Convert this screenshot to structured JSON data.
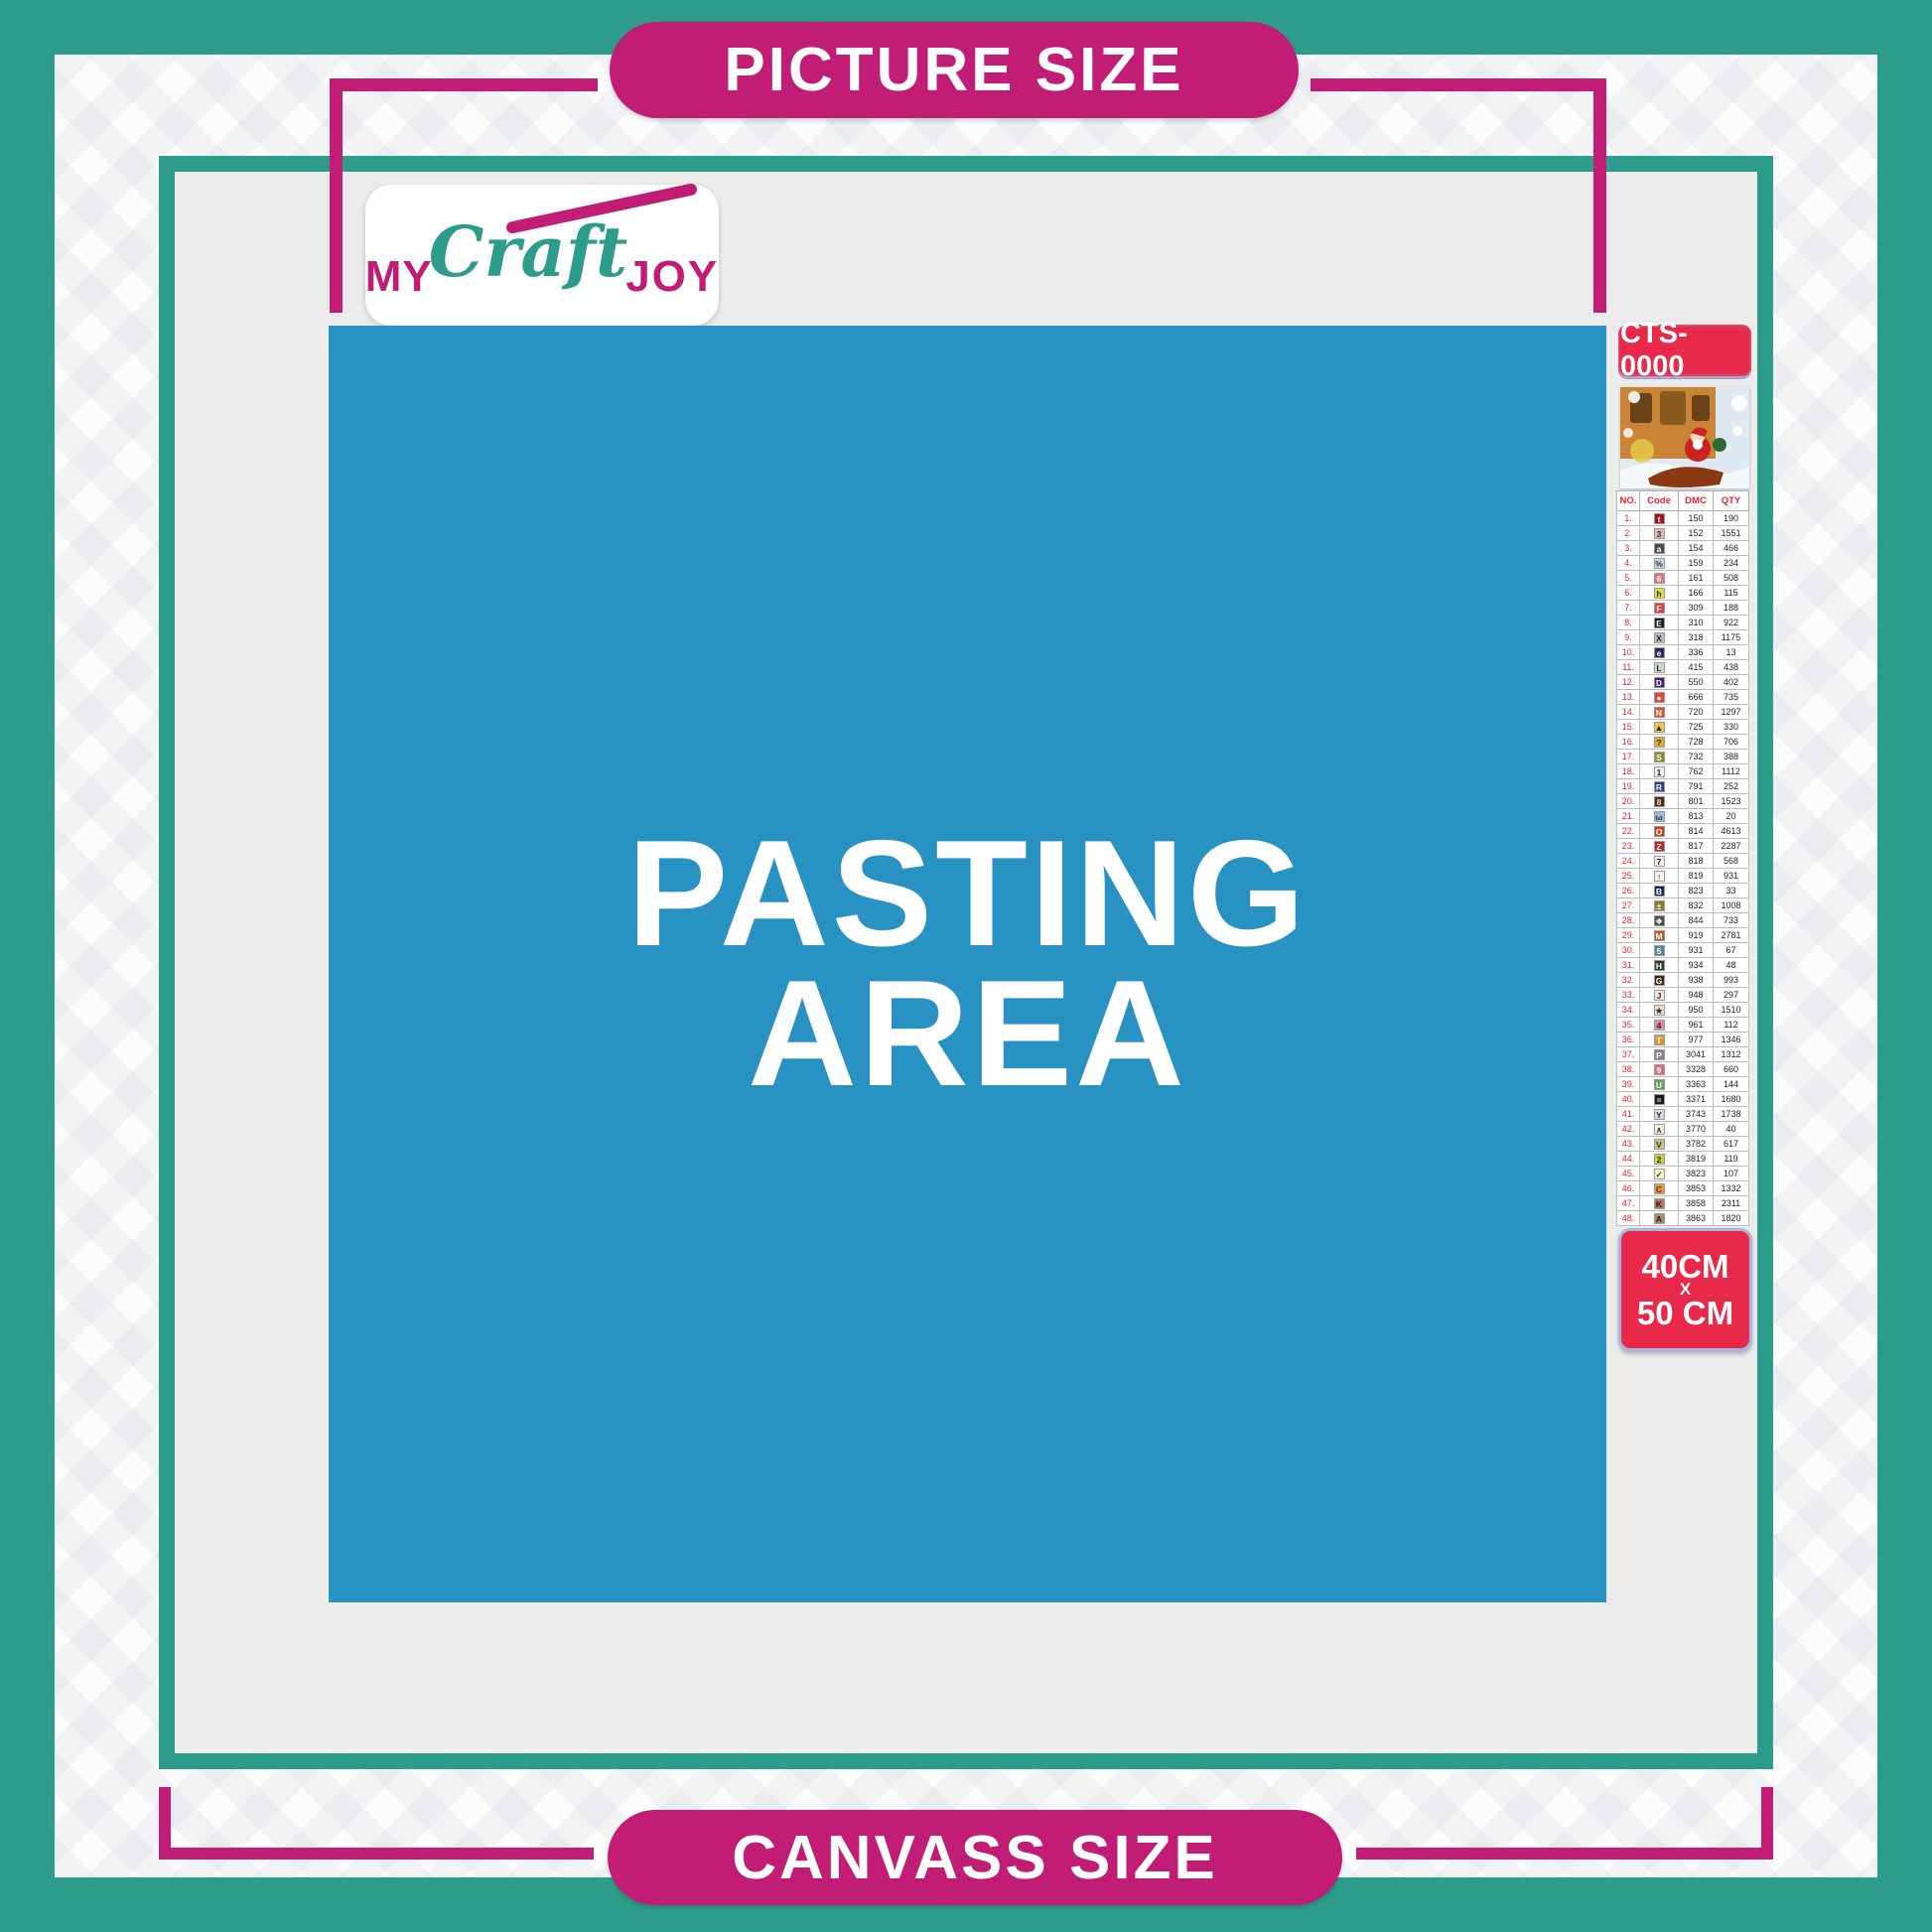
{
  "banners": {
    "top": "PICTURE SIZE",
    "bottom": "CANVASS SIZE"
  },
  "logo": {
    "part1": "MY",
    "part2": "Craft",
    "part3": "JOY"
  },
  "pasting_area": {
    "line1": "PASTING",
    "line2": "AREA"
  },
  "sidebar": {
    "sku": "CTS-0000",
    "size_label": {
      "line1": "40CM",
      "line2": "X",
      "line3": "50 CM"
    },
    "table": {
      "headers": [
        "NO.",
        "Code",
        "DMC",
        "QTY"
      ],
      "rows": [
        {
          "no": "1.",
          "sym": "t",
          "bg": "#a0121e",
          "fg": "#ffffff",
          "dmc": "150",
          "qty": "190"
        },
        {
          "no": "2.",
          "sym": "3",
          "bg": "#e3b6ba",
          "fg": "#333333",
          "dmc": "152",
          "qty": "1551"
        },
        {
          "no": "3.",
          "sym": "a",
          "bg": "#4b4b4b",
          "fg": "#ffffff",
          "dmc": "154",
          "qty": "466"
        },
        {
          "no": "4.",
          "sym": "%",
          "bg": "#c7d7e8",
          "fg": "#333333",
          "dmc": "159",
          "qty": "234"
        },
        {
          "no": "5.",
          "sym": "6",
          "bg": "#e2737c",
          "fg": "#ffffff",
          "dmc": "161",
          "qty": "508"
        },
        {
          "no": "6.",
          "sym": "h",
          "bg": "#dede3c",
          "fg": "#333333",
          "dmc": "166",
          "qty": "115"
        },
        {
          "no": "7.",
          "sym": "F",
          "bg": "#e04040",
          "fg": "#ffffff",
          "dmc": "309",
          "qty": "188"
        },
        {
          "no": "8.",
          "sym": "E",
          "bg": "#191919",
          "fg": "#ffffff",
          "dmc": "310",
          "qty": "922"
        },
        {
          "no": "9.",
          "sym": "X",
          "bg": "#bcbcbc",
          "fg": "#222222",
          "dmc": "318",
          "qty": "1175"
        },
        {
          "no": "10.",
          "sym": "e",
          "bg": "#232d63",
          "fg": "#ffffff",
          "dmc": "336",
          "qty": "13"
        },
        {
          "no": "11.",
          "sym": "L",
          "bg": "#d4d4d4",
          "fg": "#222222",
          "dmc": "415",
          "qty": "438"
        },
        {
          "no": "12.",
          "sym": "D",
          "bg": "#432066",
          "fg": "#ffffff",
          "dmc": "550",
          "qty": "402"
        },
        {
          "no": "13.",
          "sym": "●",
          "bg": "#da4837",
          "fg": "#ffffff",
          "dmc": "666",
          "qty": "735"
        },
        {
          "no": "14.",
          "sym": "N",
          "bg": "#cd5a1f",
          "fg": "#ffffff",
          "dmc": "720",
          "qty": "1297"
        },
        {
          "no": "15.",
          "sym": "▲",
          "bg": "#eac93e",
          "fg": "#222222",
          "dmc": "725",
          "qty": "330"
        },
        {
          "no": "16.",
          "sym": "?",
          "bg": "#e2a92f",
          "fg": "#222222",
          "dmc": "728",
          "qty": "706"
        },
        {
          "no": "17.",
          "sym": "S",
          "bg": "#8f8f2a",
          "fg": "#ffffff",
          "dmc": "732",
          "qty": "388"
        },
        {
          "no": "18.",
          "sym": "1",
          "bg": "#f2f2f2",
          "fg": "#222222",
          "dmc": "762",
          "qty": "1112"
        },
        {
          "no": "19.",
          "sym": "R",
          "bg": "#2c3f8f",
          "fg": "#ffffff",
          "dmc": "791",
          "qty": "252"
        },
        {
          "no": "20.",
          "sym": "8",
          "bg": "#4c2c17",
          "fg": "#f0e0b0",
          "dmc": "801",
          "qty": "1523"
        },
        {
          "no": "21.",
          "sym": "ω",
          "bg": "#9cbcdc",
          "fg": "#1a2a5a",
          "dmc": "813",
          "qty": "20"
        },
        {
          "no": "22.",
          "sym": "O",
          "bg": "#cc3f1d",
          "fg": "#ffffff",
          "dmc": "814",
          "qty": "4613"
        },
        {
          "no": "23.",
          "sym": "Z",
          "bg": "#c02525",
          "fg": "#ffffff",
          "dmc": "817",
          "qty": "2287"
        },
        {
          "no": "24.",
          "sym": "7",
          "bg": "#fbecef",
          "fg": "#222222",
          "dmc": "818",
          "qty": "568"
        },
        {
          "no": "25.",
          "sym": "↑",
          "bg": "#faf1ea",
          "fg": "#222222",
          "dmc": "819",
          "qty": "931"
        },
        {
          "no": "26.",
          "sym": "B",
          "bg": "#1b2560",
          "fg": "#ffffff",
          "dmc": "823",
          "qty": "33"
        },
        {
          "no": "27.",
          "sym": "±",
          "bg": "#8f7d2f",
          "fg": "#ffffff",
          "dmc": "832",
          "qty": "1008"
        },
        {
          "no": "28.",
          "sym": "❖",
          "bg": "#4e4e46",
          "fg": "#dddddd",
          "dmc": "844",
          "qty": "733"
        },
        {
          "no": "29.",
          "sym": "M",
          "bg": "#bf5a2b",
          "fg": "#ffffff",
          "dmc": "919",
          "qty": "2781"
        },
        {
          "no": "30.",
          "sym": "5",
          "bg": "#50859c",
          "fg": "#ffffff",
          "dmc": "931",
          "qty": "67"
        },
        {
          "no": "31.",
          "sym": "H",
          "bg": "#2e3a2e",
          "fg": "#ffffff",
          "dmc": "934",
          "qty": "48"
        },
        {
          "no": "32.",
          "sym": "G",
          "bg": "#3b2a18",
          "fg": "#ffffff",
          "dmc": "938",
          "qty": "993"
        },
        {
          "no": "33.",
          "sym": "J",
          "bg": "#f6e3d2",
          "fg": "#333333",
          "dmc": "948",
          "qty": "297"
        },
        {
          "no": "34.",
          "sym": "★",
          "bg": "#f1d9c4",
          "fg": "#333333",
          "dmc": "950",
          "qty": "1510"
        },
        {
          "no": "35.",
          "sym": "4",
          "bg": "#df8ba2",
          "fg": "#5a1a2a",
          "dmc": "961",
          "qty": "112"
        },
        {
          "no": "36.",
          "sym": "T",
          "bg": "#dd9434",
          "fg": "#ffffff",
          "dmc": "977",
          "qty": "1346"
        },
        {
          "no": "37.",
          "sym": "P",
          "bg": "#8d7f94",
          "fg": "#ffffff",
          "dmc": "3041",
          "qty": "1312"
        },
        {
          "no": "38.",
          "sym": "9",
          "bg": "#df6c7c",
          "fg": "#ffffff",
          "dmc": "3328",
          "qty": "660"
        },
        {
          "no": "39.",
          "sym": "U",
          "bg": "#6d9a60",
          "fg": "#ffffff",
          "dmc": "3363",
          "qty": "144"
        },
        {
          "no": "40.",
          "sym": "=",
          "bg": "#1a1a1a",
          "fg": "#ffffff",
          "dmc": "3371",
          "qty": "1680"
        },
        {
          "no": "41.",
          "sym": "Y",
          "bg": "#d9d9e2",
          "fg": "#333333",
          "dmc": "3743",
          "qty": "1738"
        },
        {
          "no": "42.",
          "sym": "∧",
          "bg": "#f8eddc",
          "fg": "#333333",
          "dmc": "3770",
          "qty": "40"
        },
        {
          "no": "43.",
          "sym": "V",
          "bg": "#cdc08f",
          "fg": "#333333",
          "dmc": "3782",
          "qty": "617"
        },
        {
          "no": "44.",
          "sym": "2",
          "bg": "#c9cf39",
          "fg": "#333333",
          "dmc": "3819",
          "qty": "119"
        },
        {
          "no": "45.",
          "sym": "✓",
          "bg": "#f7f0c8",
          "fg": "#333333",
          "dmc": "3823",
          "qty": "107"
        },
        {
          "no": "46.",
          "sym": "C",
          "bg": "#e0934e",
          "fg": "#6a3000",
          "dmc": "3853",
          "qty": "1332"
        },
        {
          "no": "47.",
          "sym": "K",
          "bg": "#b3796a",
          "fg": "#3a1510",
          "dmc": "3858",
          "qty": "2311"
        },
        {
          "no": "48.",
          "sym": "A",
          "bg": "#a98f72",
          "fg": "#2e2216",
          "dmc": "3863",
          "qty": "1820"
        }
      ]
    }
  },
  "colors": {
    "teal": "#2e9c8a",
    "magenta": "#c11d74",
    "crimson_label": "#e8294a",
    "pasting_blue": "#2892c2",
    "frame_fill": "#ececec",
    "table_accent_red": "#e8232d"
  }
}
